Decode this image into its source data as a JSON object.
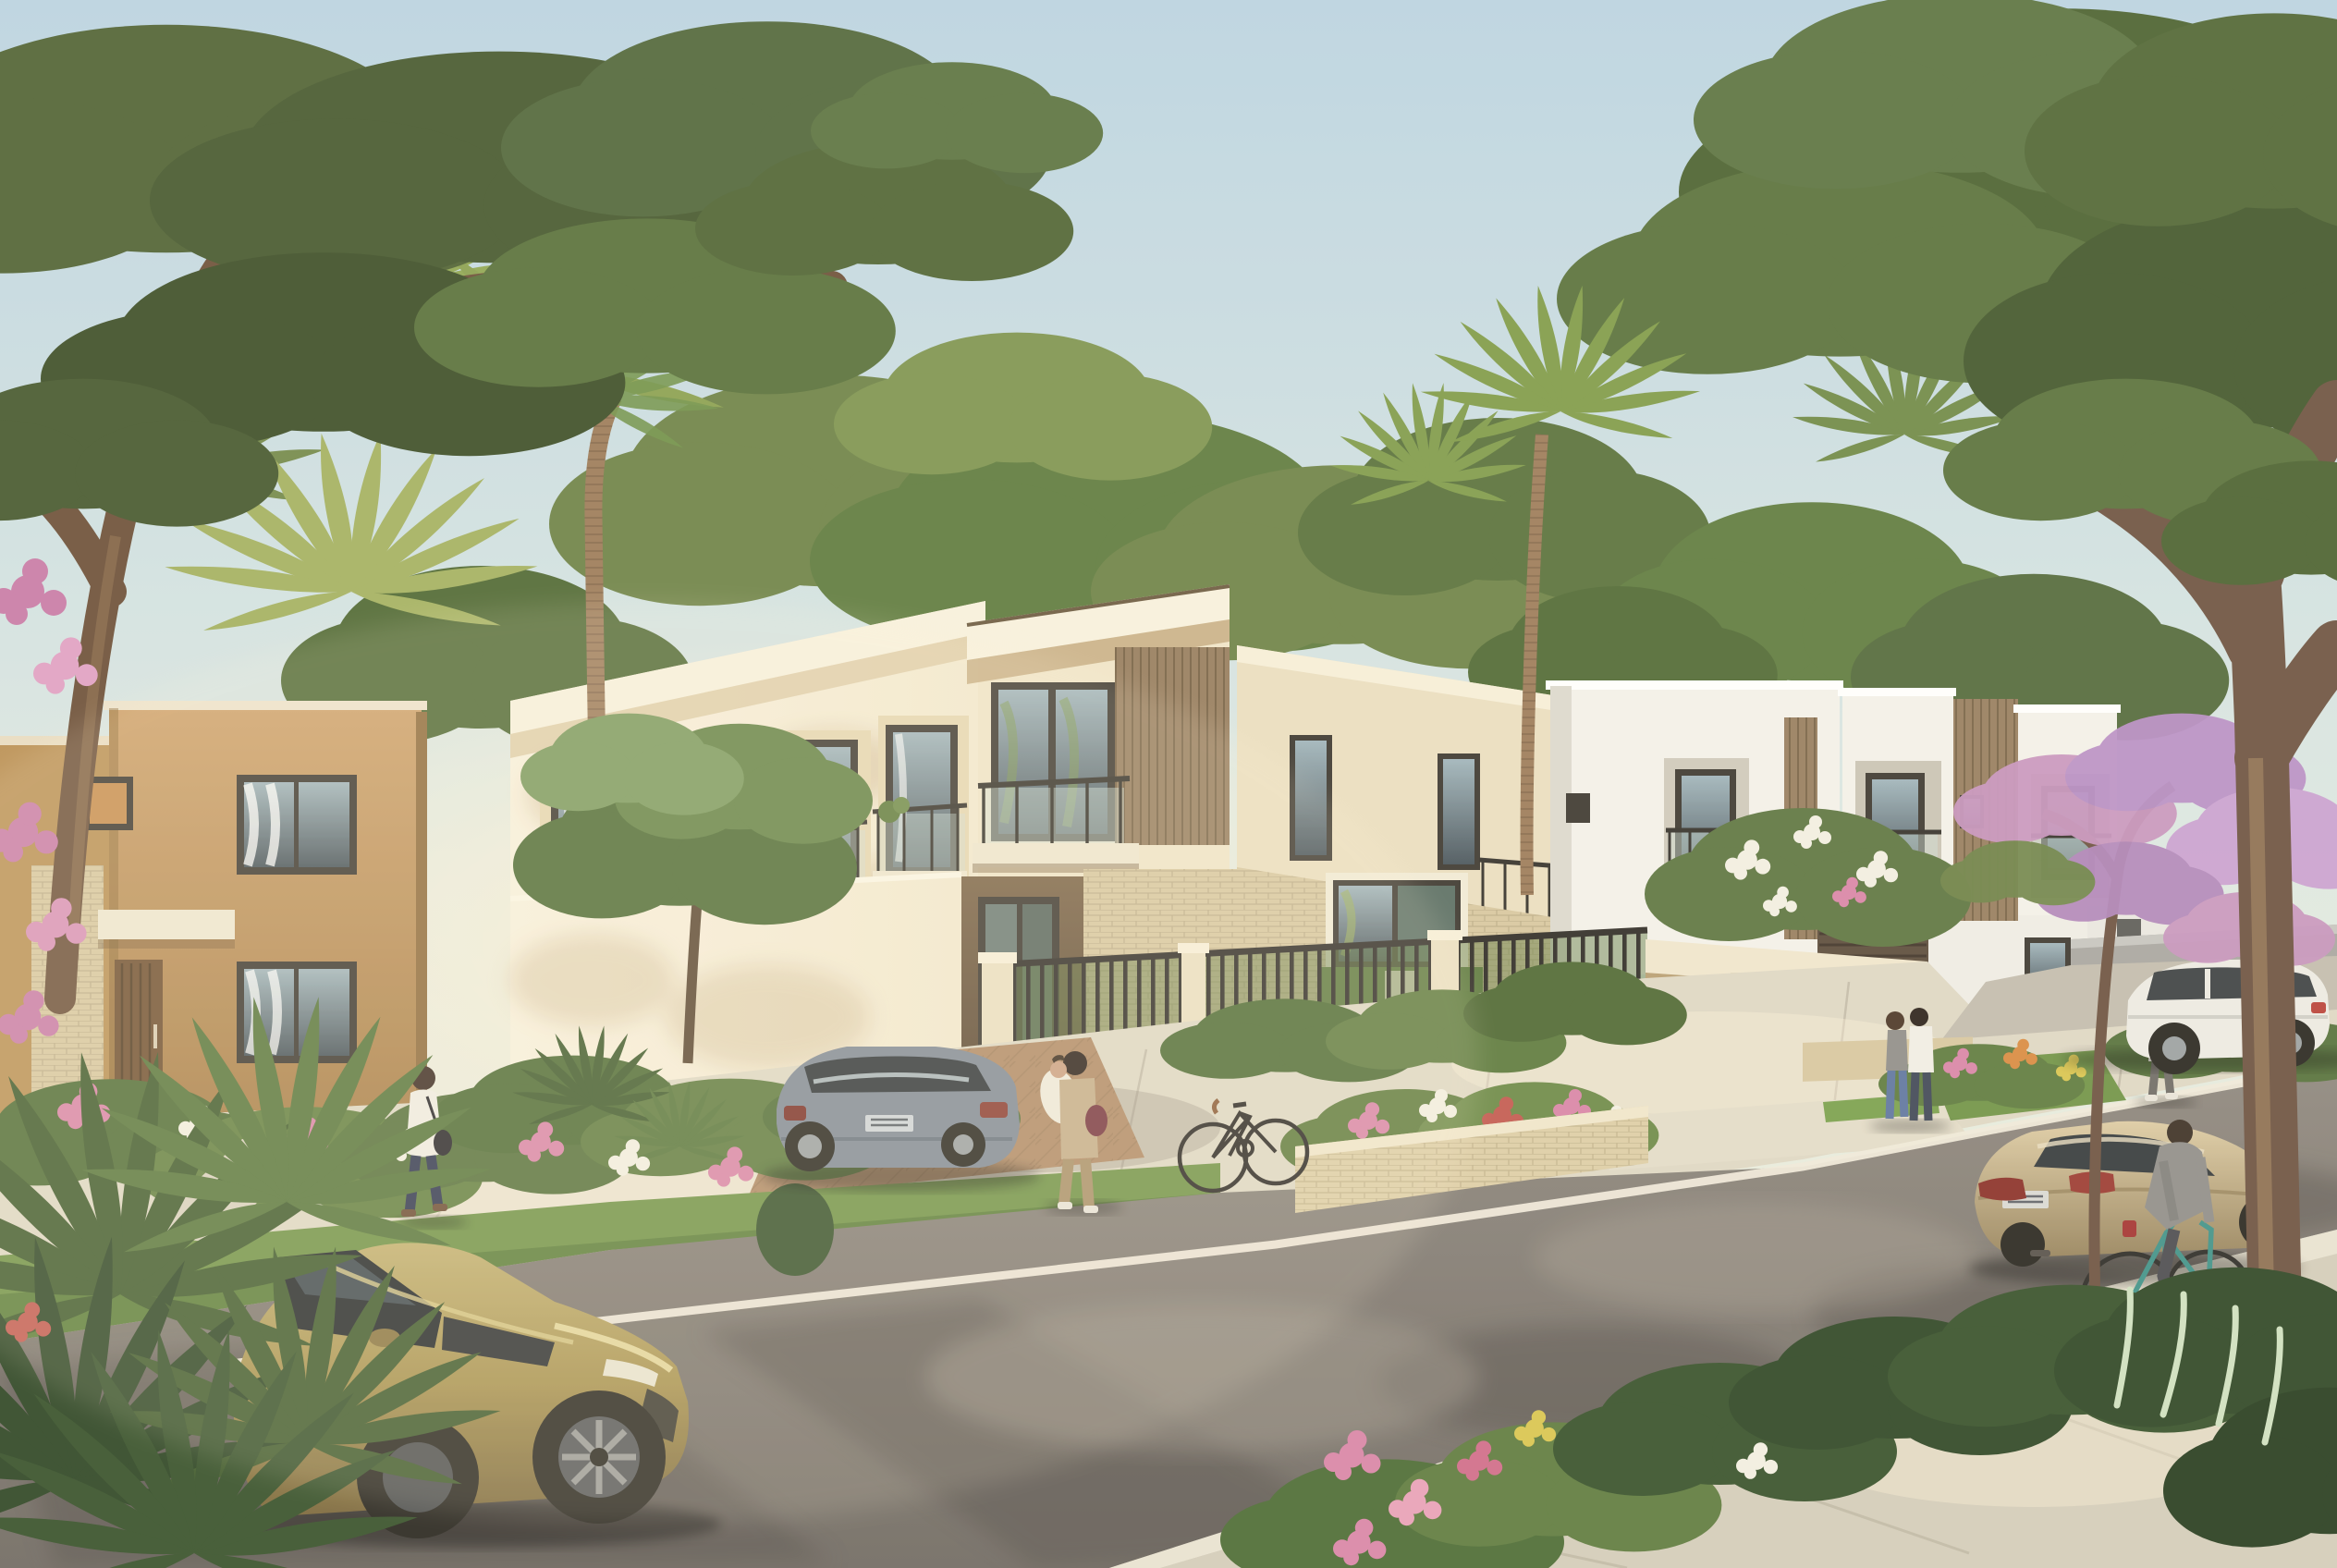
{
  "meta": {
    "scene_type": "photorealistic architectural rendering",
    "setting": "modern suburban residential street at golden hour",
    "sky": "clear pale blue sky with warm haze at horizon",
    "visible_text": "none"
  },
  "palette": {
    "sky_top": "#b9d3e2",
    "sky_mid": "#dde8e2",
    "sky_horizon": "#f6efd8",
    "sun_haze": "#fff3d8",
    "foliage_dark": "#3c5128",
    "foliage_mid": "#5a7238",
    "foliage_light": "#7e9a4c",
    "palm_light": "#a9b86a",
    "palm_mid": "#7e9a4a",
    "trunk_dark": "#6b5140",
    "trunk_light": "#9b7a58",
    "facade_cream": "#f2e8cf",
    "facade_cream_hi": "#f8f1de",
    "facade_cream_shade": "#dccaa5",
    "facade_tan": "#cda06a",
    "facade_tan_shade": "#a87e47",
    "facade_white": "#f3f1ea",
    "facade_white_shade": "#d9d6cd",
    "brick_light": "#d7c7a0",
    "wood_accent": "#967c5e",
    "frame_dark": "#3a362f",
    "glass_dark": "#46525a",
    "glass_sky": "#9fb4bc",
    "wall_gray": "#a7a5a1",
    "asphalt": "#8d867e",
    "asphalt_shadow": "#55504b",
    "sidewalk": "#ded7c5",
    "sidewalk_shade": "#c6bfae",
    "paver_warm": "#b08a66",
    "curb_white": "#efe9da",
    "grass": "#6f9246",
    "grass_shade": "#4f7030",
    "flower_pink": "#d884a8",
    "flower_red": "#c25950",
    "flower_white": "#f2efe2",
    "flower_yellow": "#d9c44e",
    "blossom_violet": "#c793be",
    "car_gold": "#a8924f",
    "car_gold_dark": "#79653a",
    "car_silver": "#7f8a96",
    "car_champagne": "#c2ae85",
    "car_white": "#eceae4",
    "tire_dark": "#26241f",
    "alloy": "#9aa0a2",
    "metal_fence": "#2e2b26",
    "teal": "#3f9188",
    "skin": "#caa083",
    "denim": "#5d74a0",
    "navy": "#2e3550",
    "khaki": "#b5a078",
    "maroon": "#76343f",
    "gray_cloth": "#8f8d8a",
    "white_cloth": "#f0ede4"
  },
  "scene": {
    "objects": {
      "sky": {
        "label": "clear golden-hour sky"
      },
      "canopy_left": {
        "label": "large overhanging tree, top left"
      },
      "canopy_right": {
        "label": "large overhanging tree, top right"
      },
      "background_foliage": {
        "label": "background trees behind buildings"
      },
      "palms": {
        "label": "fan and date palm trees"
      },
      "villa_tan": {
        "label": "two-storey tan stucco villa, left"
      },
      "townhouse_row": {
        "label": "cream townhouse row with balconies"
      },
      "corner_unit": {
        "label": "corner unit with glass balcony and wood slats"
      },
      "brick_wing": {
        "label": "brick-faced wing with large picture window"
      },
      "white_villa_near": {
        "label": "white modern villa"
      },
      "white_duplex": {
        "label": "white duplex with wood slat core"
      },
      "perimeter_wall": {
        "label": "grey perimeter wall"
      },
      "entrance_gate": {
        "label": "community entrance gate with pergola"
      },
      "metal_fence": {
        "label": "black metal fence on brick base"
      },
      "flower_planter": {
        "label": "brick planter with flowers"
      },
      "sidewalk": {
        "label": "concrete sidewalk"
      },
      "grass_verge": {
        "label": "grass verge"
      },
      "street": {
        "label": "asphalt street with tree shadows"
      },
      "road_line": {
        "label": "white road edge line"
      },
      "foreground_walkway": {
        "label": "paved walkway, foreground"
      },
      "driveway": {
        "label": "paver driveway apron"
      },
      "garden_beds": {
        "label": "flowering garden beds"
      },
      "foreground_shrubs": {
        "label": "foreground shrubs with pink flowers"
      },
      "flowering_tree": {
        "label": "flowering tree with violet blossoms"
      },
      "gold_hatchback": {
        "label": "olive-gold hatchback parked at curb"
      },
      "silver_sedan": {
        "label": "silver-blue sedan on driveway"
      },
      "champagne_sedan": {
        "label": "champagne sedan driving on street"
      },
      "white_suv": {
        "label": "white SUV parked near perimeter wall"
      },
      "parked_bicycle": {
        "label": "bicycle leaning on fence pillar"
      },
      "cyclist": {
        "label": "cyclist in grey jacket"
      },
      "pedestrian_left": {
        "label": "woman walking with shoulder bag"
      },
      "resident_with_child": {
        "label": "resident carrying a child"
      },
      "couple_at_gate": {
        "label": "couple talking at the gate"
      },
      "pedestrian_right": {
        "label": "pedestrian on right sidewalk"
      }
    }
  }
}
